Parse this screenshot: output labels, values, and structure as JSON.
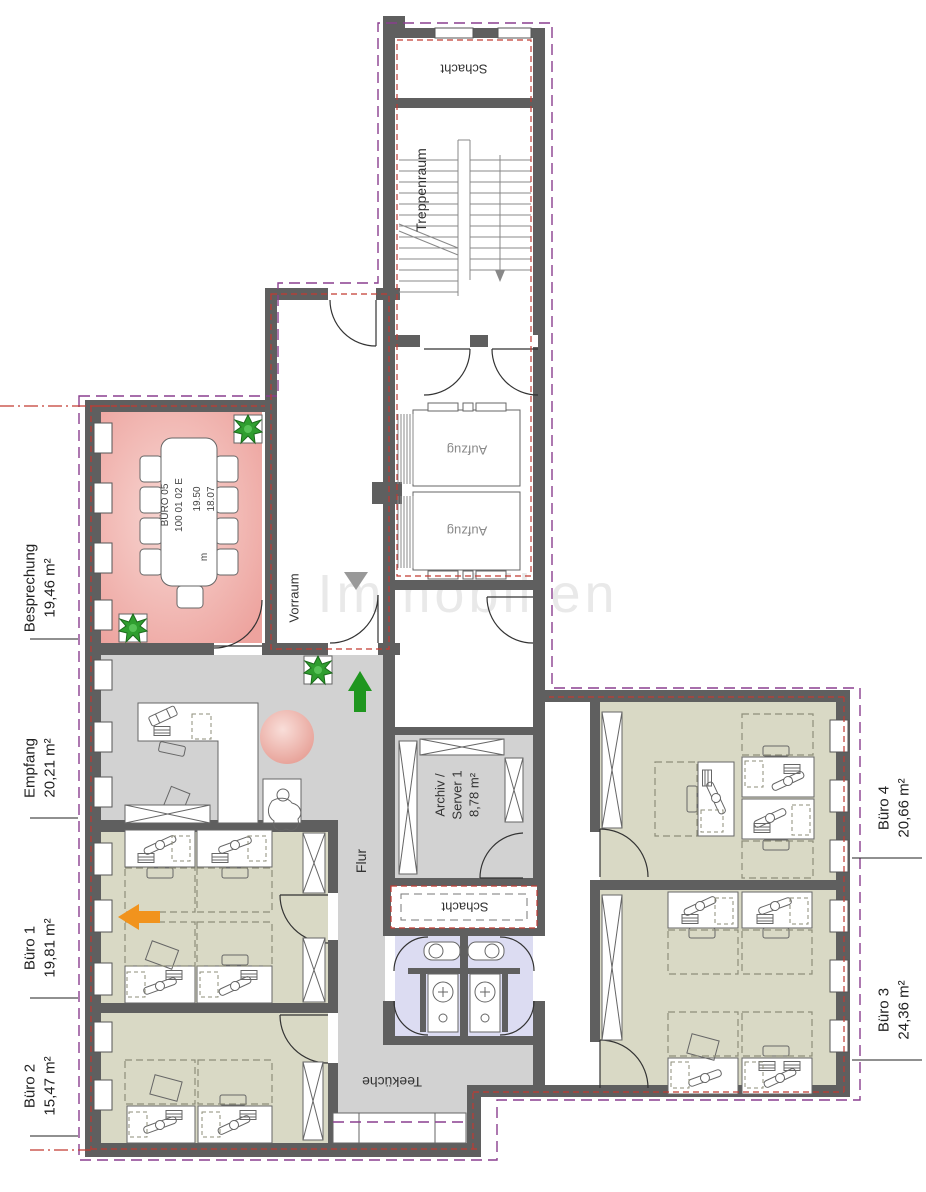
{
  "rooms": {
    "besprechung": {
      "name": "Besprechung",
      "area": "19,46 m²"
    },
    "empfang": {
      "name": "Empfang",
      "area": "20,21 m²"
    },
    "buero1": {
      "name": "Büro 1",
      "area": "19,81 m²"
    },
    "buero2": {
      "name": "Büro 2",
      "area": "15,47 m²"
    },
    "buero3": {
      "name": "Büro 3",
      "area": "24,36 m²"
    },
    "buero4": {
      "name": "Büro 4",
      "area": "20,66 m²"
    },
    "flur": {
      "name": "Flur"
    },
    "teekueche": {
      "name": "Teeküche"
    },
    "vorraum": {
      "name": "Vorraum"
    },
    "treppenraum": {
      "name": "Treppenraum"
    },
    "schacht_oben": {
      "name": "Schacht"
    },
    "schacht_mitte": {
      "name": "Schacht"
    },
    "aufzug_1": {
      "name": "Aufzug"
    },
    "aufzug_2": {
      "name": "Aufzug"
    },
    "archiv": {
      "name_line1": "Archiv /",
      "name_line2": "Server 1",
      "area": "8,78 m²"
    }
  },
  "room_stamp": {
    "line1": "BÜRO 05",
    "line2": "100 01 02 E",
    "line3": "19.50",
    "line4": "18.07",
    "line5": "m"
  },
  "watermark": "Immobilien",
  "colors": {
    "wall": "#5f5f5f",
    "meeting_room": "#efa9a4",
    "office": "#d9d9c5",
    "corridor": "#d2d2d2",
    "wc": "#dcdcf2",
    "boundary_purple": "#8a3f8f",
    "boundary_red": "#c23a32",
    "plant_green": "#2f9e2f",
    "arrow_green": "#1f961f",
    "arrow_orange": "#f1931d",
    "ball_pink": "#eda49c"
  }
}
